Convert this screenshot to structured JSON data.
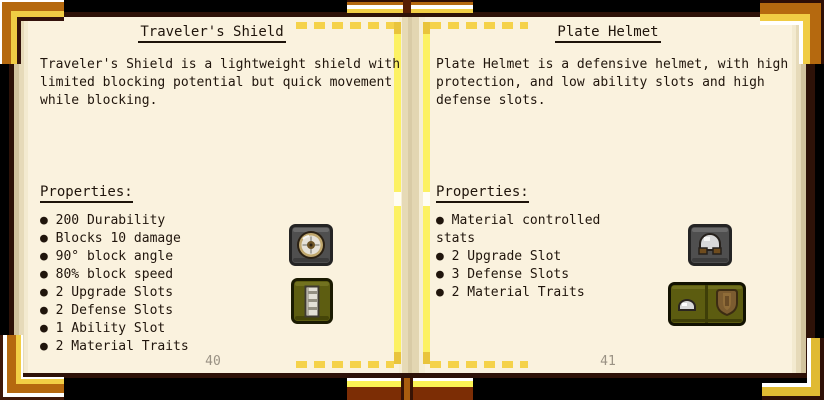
{
  "bullet_glyph": "●",
  "book": {
    "left_page": {
      "title": "Traveler's Shield",
      "description": "Traveler's Shield is a lightweight shield with\nlimited blocking potential but quick movement\nwhile blocking.",
      "properties_label": "Properties:",
      "properties": [
        "200 Durability",
        "Blocks 10 damage",
        "90° block angle",
        "80% block speed",
        "2 Upgrade Slots",
        "2 Defense Slots",
        "1 Ability Slot",
        "2 Material Traits"
      ],
      "page_number": "40",
      "icons": [
        {
          "name": "travelers-shield-item-icon"
        },
        {
          "name": "shield-pattern-item-icon"
        }
      ]
    },
    "right_page": {
      "title": "Plate Helmet",
      "description": "Plate Helmet is a defensive helmet, with high\nprotection, and low ability slots and high\ndefense slots.",
      "properties_label": "Properties:",
      "properties": [
        "Material controlled stats",
        "2 Upgrade Slot",
        "3 Defense Slots",
        "2 Material Traits"
      ],
      "page_number": "41",
      "icons": [
        {
          "name": "plate-helmet-item-icon"
        },
        {
          "name": "helmet-parts-slots-icon"
        }
      ]
    }
  },
  "colors": {
    "page_cream": "#faf2de",
    "page_border_brown": "#2e1208",
    "dash_gold": "#f5d24a",
    "line_yellow": "#fcf163",
    "clasp_orange": "#b5690f",
    "clasp_yellow": "#f0cc44",
    "cover_burnt_orange": "#7c2d05",
    "text_dark": "#20150c",
    "page_number_gray": "#9a9284",
    "slot_gray": "#4f4f4f",
    "slot_olive": "#5c5c10"
  }
}
